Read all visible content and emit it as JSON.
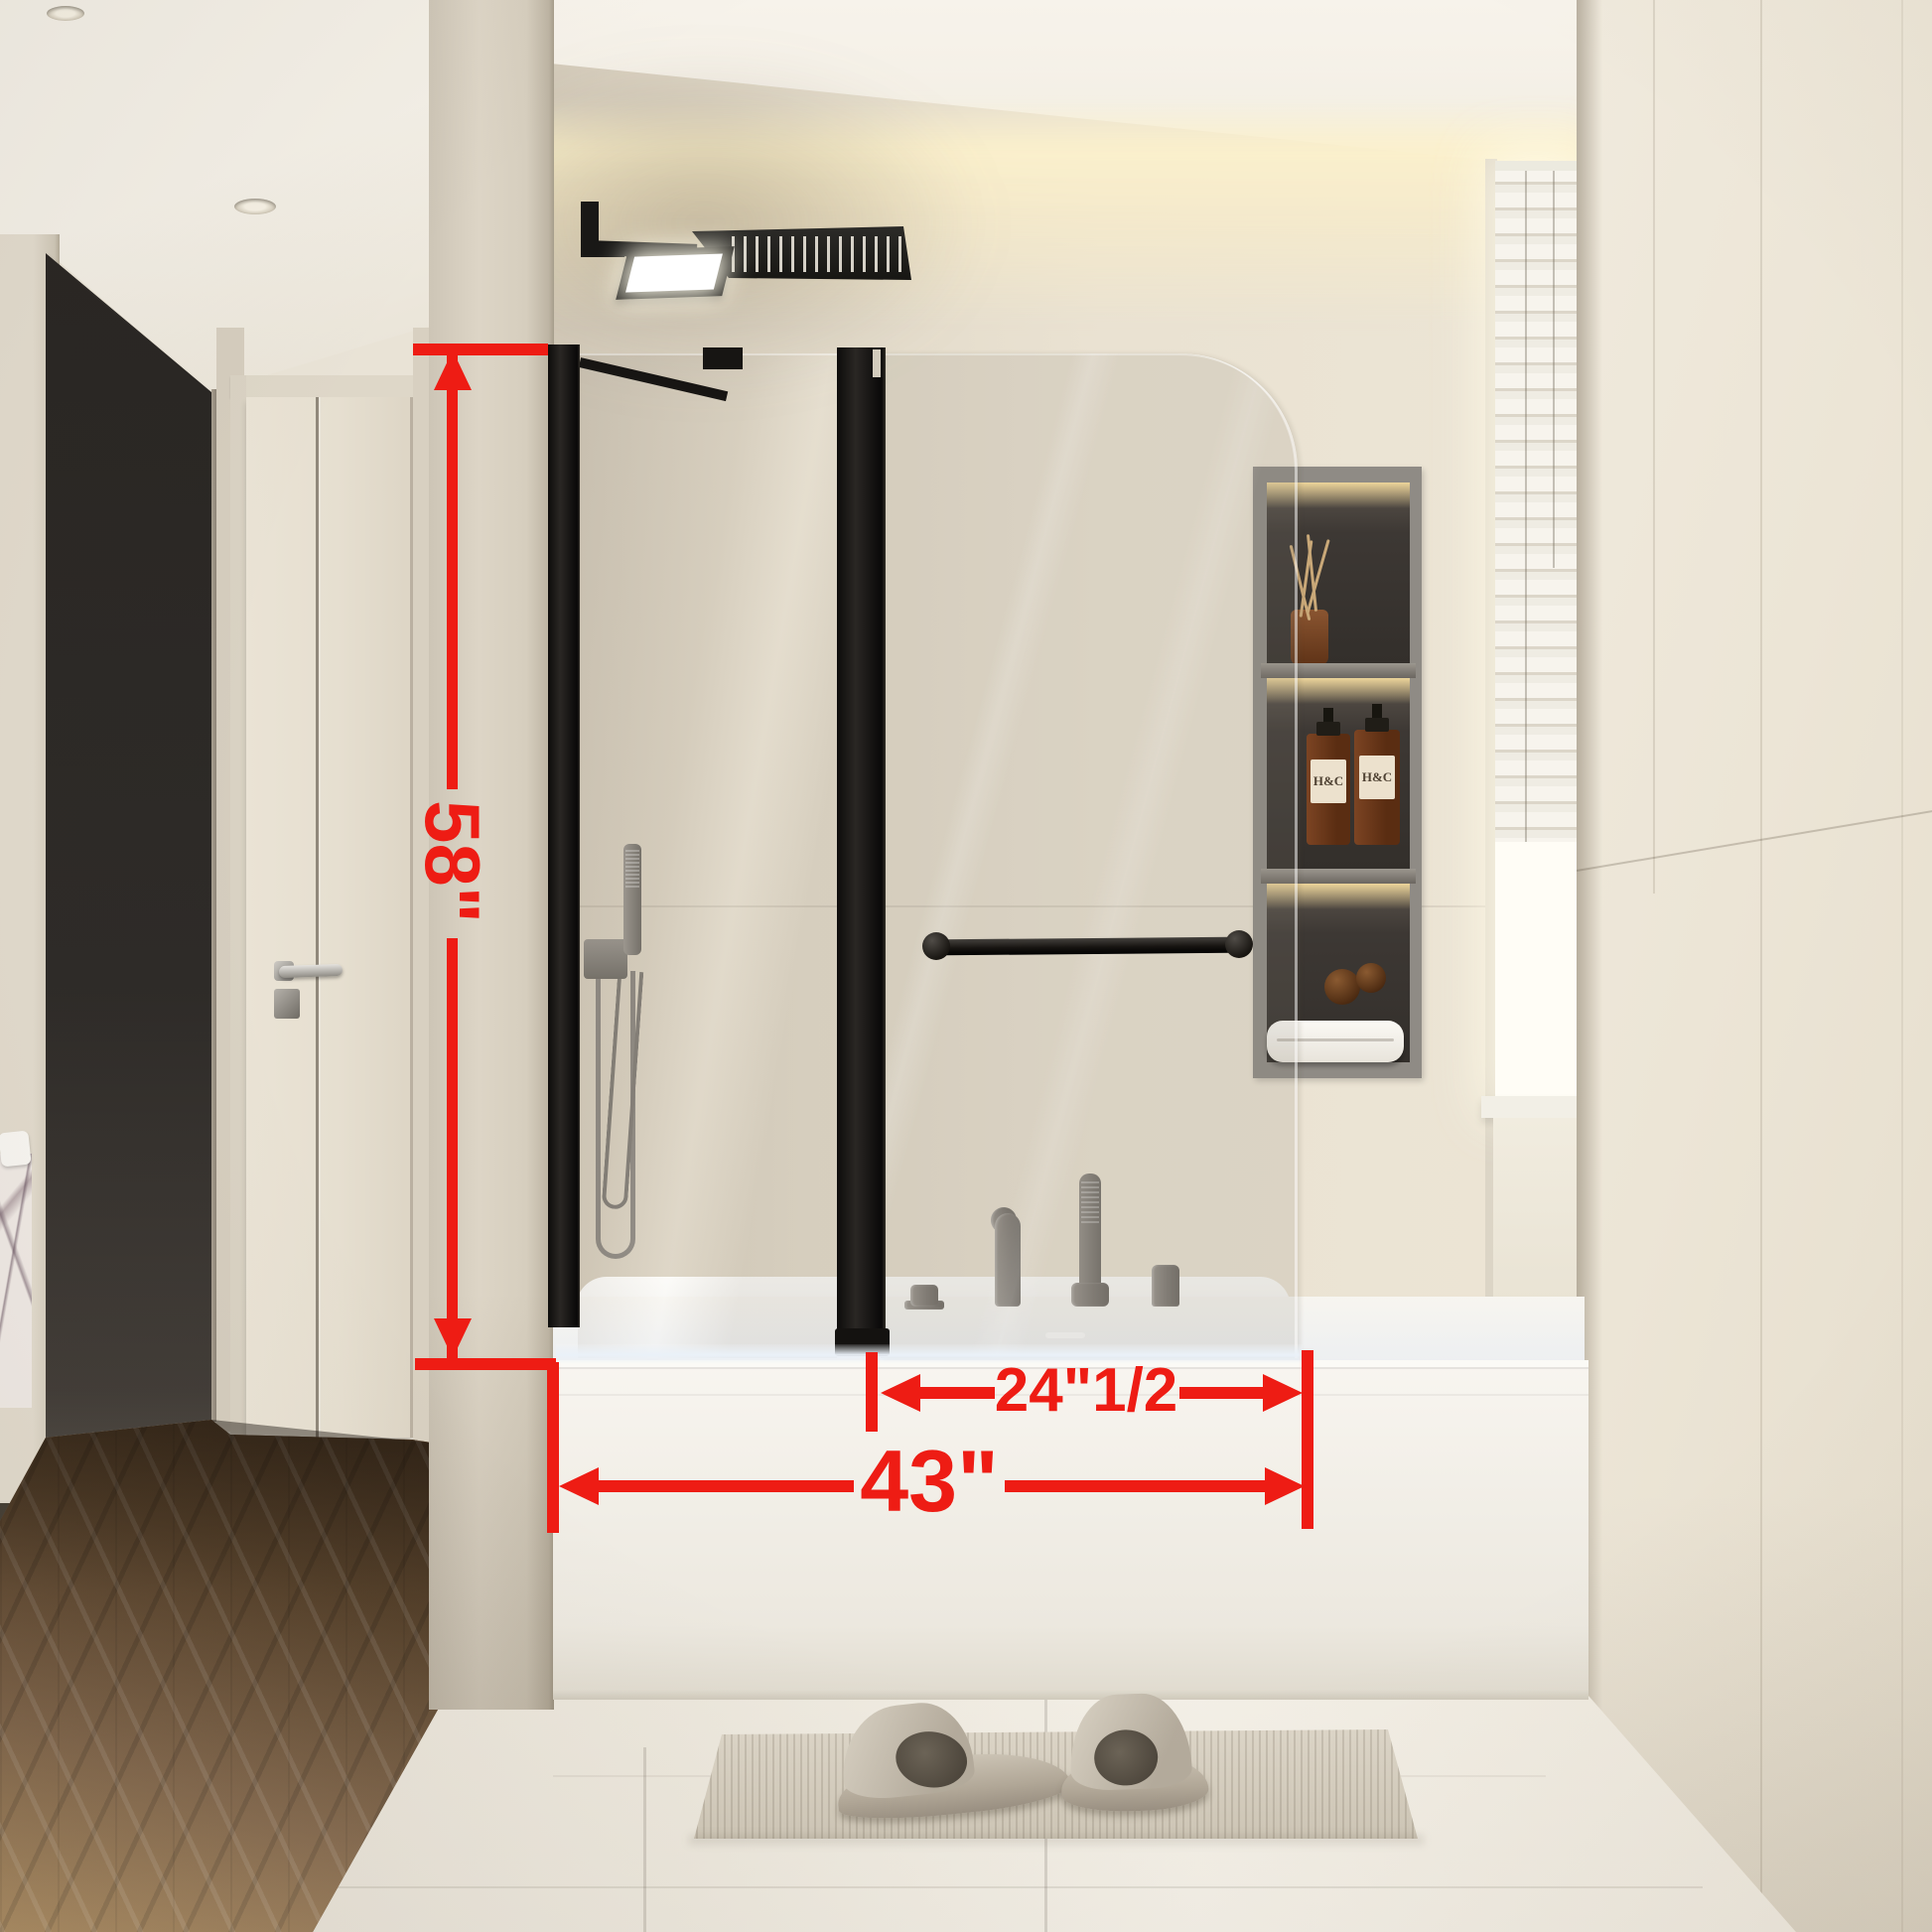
{
  "image": {
    "description": "Photorealistic bathroom render of a black-framed pivoting bathtub shower screen with red dimension annotations",
    "annotation_color": "#ee1c14",
    "frame_color": "#191714"
  },
  "annotations": {
    "height": "58\"",
    "total_width": "43\"",
    "panel_width": "24\"1/2"
  },
  "niche": {
    "bottle_brand": "H&C"
  }
}
